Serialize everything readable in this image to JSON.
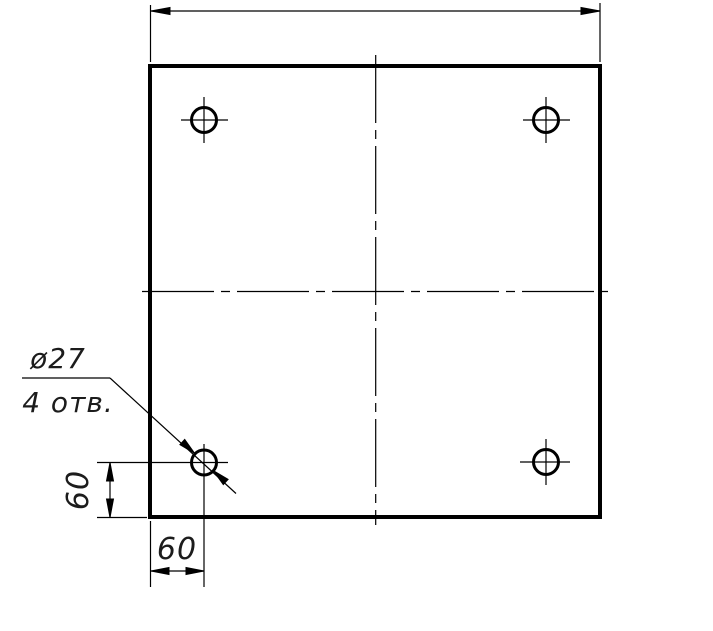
{
  "drawing": {
    "callout": {
      "diameter": "ø27",
      "count": "4 отв."
    },
    "dimensions": {
      "hole_offset_vertical": "60",
      "hole_offset_horizontal": "60"
    },
    "colors": {
      "line": "#000000",
      "background": "#ffffff",
      "text": "#1c1c1c"
    }
  }
}
